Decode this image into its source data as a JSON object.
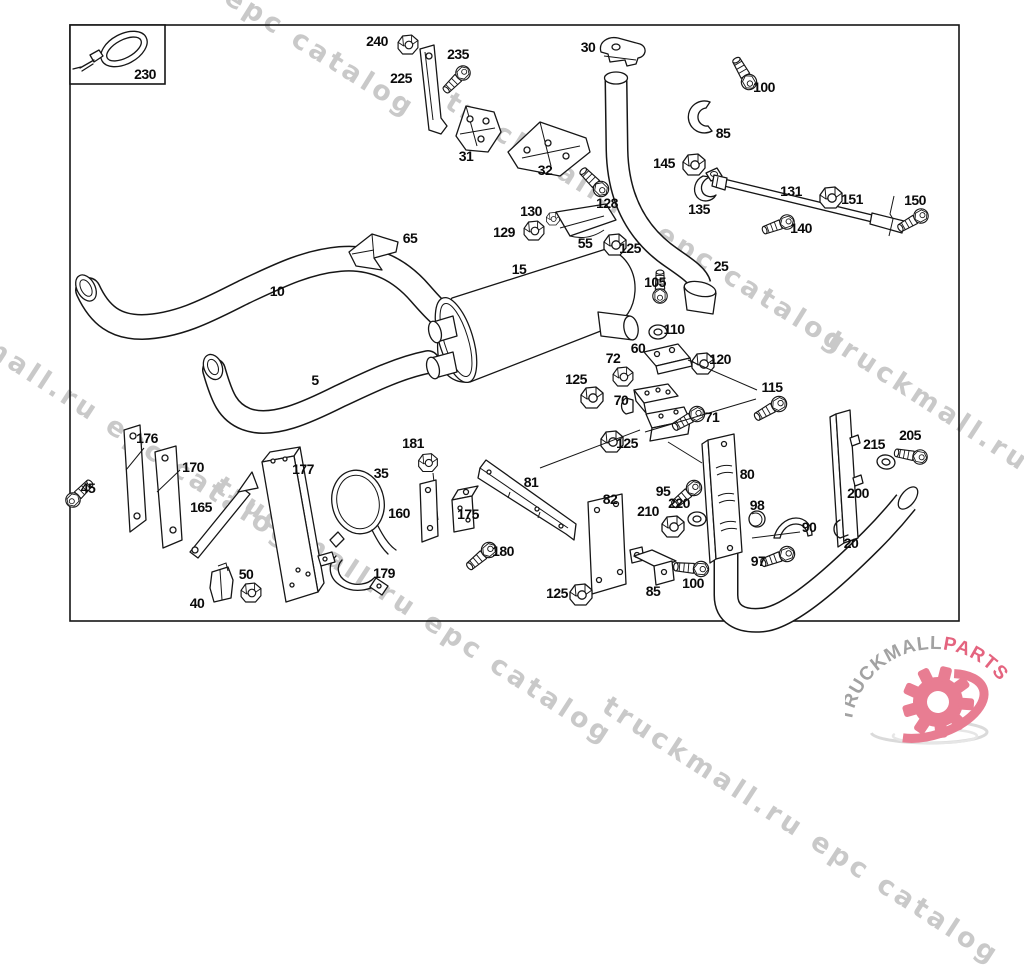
{
  "diagram": {
    "description": "Exploded parts diagram of truck exhaust system",
    "part_labels": [
      {
        "n": "230",
        "x": 145,
        "y": 74
      },
      {
        "n": "240",
        "x": 377,
        "y": 41
      },
      {
        "n": "225",
        "x": 401,
        "y": 78
      },
      {
        "n": "235",
        "x": 458,
        "y": 54
      },
      {
        "n": "31",
        "x": 466,
        "y": 156
      },
      {
        "n": "32",
        "x": 545,
        "y": 170
      },
      {
        "n": "30",
        "x": 588,
        "y": 47
      },
      {
        "n": "100",
        "x": 764,
        "y": 87
      },
      {
        "n": "85",
        "x": 723,
        "y": 133
      },
      {
        "n": "145",
        "x": 664,
        "y": 163
      },
      {
        "n": "135",
        "x": 699,
        "y": 209
      },
      {
        "n": "131",
        "x": 791,
        "y": 191
      },
      {
        "n": "151",
        "x": 852,
        "y": 199
      },
      {
        "n": "150",
        "x": 915,
        "y": 200
      },
      {
        "n": "140",
        "x": 801,
        "y": 228
      },
      {
        "n": "128",
        "x": 607,
        "y": 203
      },
      {
        "n": "130",
        "x": 531,
        "y": 211
      },
      {
        "n": "129",
        "x": 504,
        "y": 232
      },
      {
        "n": "55",
        "x": 585,
        "y": 243
      },
      {
        "n": "125",
        "x": 630,
        "y": 248
      },
      {
        "n": "65",
        "x": 410,
        "y": 238
      },
      {
        "n": "25",
        "x": 721,
        "y": 266
      },
      {
        "n": "15",
        "x": 519,
        "y": 269
      },
      {
        "n": "105",
        "x": 655,
        "y": 282
      },
      {
        "n": "10",
        "x": 277,
        "y": 291
      },
      {
        "n": "110",
        "x": 674,
        "y": 329
      },
      {
        "n": "5",
        "x": 315,
        "y": 380
      },
      {
        "n": "60",
        "x": 638,
        "y": 348
      },
      {
        "n": "72",
        "x": 613,
        "y": 358
      },
      {
        "n": "120",
        "x": 720,
        "y": 359
      },
      {
        "n": "125",
        "x": 576,
        "y": 379
      },
      {
        "n": "115",
        "x": 772,
        "y": 387
      },
      {
        "n": "70",
        "x": 621,
        "y": 400
      },
      {
        "n": "71",
        "x": 712,
        "y": 417
      },
      {
        "n": "125",
        "x": 627,
        "y": 443
      },
      {
        "n": "176",
        "x": 147,
        "y": 438
      },
      {
        "n": "170",
        "x": 193,
        "y": 467
      },
      {
        "n": "45",
        "x": 88,
        "y": 488
      },
      {
        "n": "165",
        "x": 201,
        "y": 507
      },
      {
        "n": "177",
        "x": 303,
        "y": 469
      },
      {
        "n": "35",
        "x": 381,
        "y": 473
      },
      {
        "n": "181",
        "x": 413,
        "y": 443
      },
      {
        "n": "160",
        "x": 399,
        "y": 513
      },
      {
        "n": "175",
        "x": 468,
        "y": 514
      },
      {
        "n": "81",
        "x": 531,
        "y": 482
      },
      {
        "n": "82",
        "x": 610,
        "y": 499
      },
      {
        "n": "180",
        "x": 503,
        "y": 551
      },
      {
        "n": "95",
        "x": 663,
        "y": 491
      },
      {
        "n": "220",
        "x": 679,
        "y": 503
      },
      {
        "n": "210",
        "x": 648,
        "y": 511
      },
      {
        "n": "80",
        "x": 747,
        "y": 474
      },
      {
        "n": "98",
        "x": 757,
        "y": 505
      },
      {
        "n": "90",
        "x": 809,
        "y": 527
      },
      {
        "n": "97",
        "x": 758,
        "y": 561
      },
      {
        "n": "100",
        "x": 693,
        "y": 583
      },
      {
        "n": "85",
        "x": 653,
        "y": 591
      },
      {
        "n": "125",
        "x": 557,
        "y": 593
      },
      {
        "n": "40",
        "x": 197,
        "y": 603
      },
      {
        "n": "50",
        "x": 246,
        "y": 574
      },
      {
        "n": "179",
        "x": 384,
        "y": 573
      },
      {
        "n": "200",
        "x": 858,
        "y": 493
      },
      {
        "n": "215",
        "x": 874,
        "y": 444
      },
      {
        "n": "205",
        "x": 910,
        "y": 435
      },
      {
        "n": "20",
        "x": 851,
        "y": 543
      }
    ]
  },
  "watermarks": [
    {
      "text": "epc catalog",
      "x": 227,
      "y": -21,
      "angle": 32
    },
    {
      "text": "truckmall.ru epc catalog",
      "x": 448,
      "y": 84,
      "angle": 32
    },
    {
      "text": "truckmall.ru epc catalog",
      "x": 830,
      "y": 322,
      "angle": 33
    },
    {
      "text": "truckmall.ru epc catalog",
      "x": -100,
      "y": 272,
      "angle": 33
    },
    {
      "text": "truckmall.ru epc catalog",
      "x": 218,
      "y": 468,
      "angle": 33
    },
    {
      "text": "truckmall.ru epc catalog",
      "x": 605,
      "y": 688,
      "angle": 33
    }
  ],
  "logo": {
    "name_part1": "TRUCKMALL",
    "name_part2": "PARTS",
    "gray": "#a2a2a2",
    "pink": "#e4647f",
    "gear_pink": "#e87d92"
  }
}
